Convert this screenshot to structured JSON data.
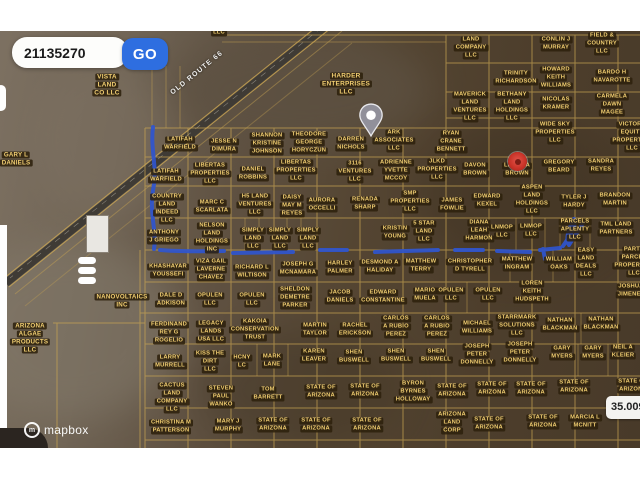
{
  "search": {
    "value": "21135270",
    "go_label": "GO"
  },
  "colors": {
    "goBlue": "#2e6ee0",
    "route": "#2f55cf",
    "markerRed": "#c93328",
    "labelText": "#f2cf72",
    "labelBg": "rgba(46,33,12,0.88)",
    "gridLine": "#c9a552"
  },
  "map": {
    "road_label": "OLD ROUTE 66",
    "coordinate_badge": "35.0096",
    "attribution": "mapbox",
    "parcel_format": [
      "text",
      "x",
      "y",
      "font_size_optional"
    ],
    "parcels": [
      [
        "VISTA\nLAND\nCO LLC",
        107,
        85,
        6.5
      ],
      [
        "LLC",
        219,
        33
      ],
      [
        "HARDER\nENTERPRISES\nLLC",
        346,
        84,
        6.5
      ],
      [
        "GARY L\nDANIELS",
        16,
        159,
        6.2
      ],
      [
        "NANOVOLTAICS\nINC",
        122,
        301,
        6.2
      ],
      [
        "ARIZONA\nALGAE\nPRODUCTS\nLLC",
        30,
        338,
        6.2
      ],
      [
        "LAND\nCOMPANY\nLLC",
        471,
        48
      ],
      [
        "CONLIN J\nMURRAY",
        556,
        44
      ],
      [
        "FIELD &\nCOUNTRY\nLLC",
        602,
        44
      ],
      [
        "TRINITY\nRICHARDSON",
        516,
        78
      ],
      [
        "HOWARD\nKEITH\nWILLIAMS",
        556,
        78
      ],
      [
        "BARDO H\nNAVAROTTE",
        612,
        77
      ],
      [
        "MAVERICK\nLAND\nVENTURES\nLLC",
        470,
        107
      ],
      [
        "BETHANY\nLAND\nHOLDINGS\nLLC",
        512,
        107
      ],
      [
        "NICOLAS\nKRAMER",
        556,
        104
      ],
      [
        "CARMELA\nDAWN\nMAGEE",
        612,
        105
      ],
      [
        "WIDE SKY\nPROPERTIES\nLLC",
        555,
        133
      ],
      [
        "VICTORY\nEQUITY\nPROPERTIES\nLLC",
        632,
        137
      ],
      [
        "RYAN\nCRANE\nBENNETT",
        451,
        142
      ],
      [
        "JLKD\nPROPERTIES\nLLC",
        437,
        170
      ],
      [
        "DAVON\nBROWN",
        475,
        170
      ],
      [
        "LATISHA\nBROWN",
        517,
        170
      ],
      [
        "GREGORY\nBEARD",
        559,
        167
      ],
      [
        "SANDRA\nREYES",
        601,
        166
      ],
      [
        "LATIFAH\nWARFIELD",
        180,
        144
      ],
      [
        "JESSE N\nDIMURA",
        224,
        146
      ],
      [
        "SHANNON\nKRISTINE\nJOHNSON",
        267,
        144
      ],
      [
        "THEODORE\nGEORGE\nHORYCZUN",
        309,
        143
      ],
      [
        "DARREN\nNICHOLS",
        351,
        144
      ],
      [
        "ARK\nASSOCIATES\nLLC",
        394,
        141
      ],
      [
        "LATIFAH\nWARFIELD",
        166,
        176
      ],
      [
        "LIBERTAS\nPROPERTIES\nLLC",
        210,
        174
      ],
      [
        "DANIEL\nROBBINS",
        253,
        174
      ],
      [
        "LIBERTAS\nPROPERTIES\nLLC",
        296,
        171
      ],
      [
        "3116\nVENTURES\nLLC",
        355,
        172
      ],
      [
        "ADRIENNE\nYVETTE\nMCCOY",
        396,
        171
      ],
      [
        "COUNTRY\nLAND\nINDEED\nLLC",
        167,
        209
      ],
      [
        "MARC C\nSCARLATA",
        212,
        207
      ],
      [
        "H5 LAND\nVENTURES\nLLC",
        255,
        205
      ],
      [
        "DAISY\nMAY M\nREYES",
        292,
        206
      ],
      [
        "AURORA\nOCCELLI",
        322,
        205
      ],
      [
        "RENADA\nSHARP",
        365,
        204
      ],
      [
        "SMP\nPROPERTIES\nLLC",
        410,
        202
      ],
      [
        "JAMES\nFOWLIE",
        452,
        205
      ],
      [
        "EDWARD\nKEXEL",
        487,
        201
      ],
      [
        "ASPEN\nLAND\nHOLDINGS\nLLC",
        532,
        200
      ],
      [
        "TYLER J\nHARDY",
        574,
        202
      ],
      [
        "BRANDON\nMARTIN",
        615,
        200
      ],
      [
        "ANTHONY\nJ GRIEGO",
        164,
        237
      ],
      [
        "NELSON\nLAND\nHOLDINGS\nINC",
        212,
        238
      ],
      [
        "SIMPLY\nLAND\nLLC",
        253,
        239
      ],
      [
        "SIMPLY\nLAND\nLLC",
        280,
        239
      ],
      [
        "SIMPLY\nLAND\nLLC",
        308,
        239
      ],
      [
        "KRISTIN\nYOUNG",
        395,
        233
      ],
      [
        "5 STAR\nLAND\nLLC",
        424,
        232
      ],
      [
        "DIANA\nLEAH\nHARMON",
        479,
        231
      ],
      [
        "LNMOP\nLLC",
        502,
        232
      ],
      [
        "LNMOP\nLLC",
        531,
        231
      ],
      [
        "PARCELS\nAPLENTY\nLLC",
        575,
        230
      ],
      [
        "TML LAND\nPARTNERS",
        616,
        229
      ],
      [
        "KHASHAYAR\nYOUSSEFI",
        168,
        271
      ],
      [
        "VIZA GAIL\nLAVERNE\nCHAVEZ",
        211,
        270
      ],
      [
        "RICHARD L\nWILTISON",
        252,
        272
      ],
      [
        "JOSEPH G\nMCNAMARA",
        298,
        269
      ],
      [
        "HARLEY\nPALMER",
        340,
        268
      ],
      [
        "DESMOND A\nHALIDAY",
        380,
        267
      ],
      [
        "MATTHEW\nTERRY",
        421,
        266
      ],
      [
        "CHRISTOPHER\nD TYRELL",
        470,
        266
      ],
      [
        "MATTHEW\nINGRAM",
        517,
        264
      ],
      [
        "WILLIAM\nOAKS",
        559,
        264
      ],
      [
        "EASY\nLAND\nDEALS\nLLC",
        586,
        263
      ],
      [
        "PARTY\nPARCEL\nPROPERTIES\nLLC",
        634,
        262
      ],
      [
        "DALE D\nADKISON",
        171,
        300
      ],
      [
        "OPULEN\nLLC",
        210,
        300
      ],
      [
        "OPULEN\nLLC",
        252,
        300
      ],
      [
        "SHELDON\nDEMETRE\nPARKER",
        295,
        298
      ],
      [
        "JACOB\nDANIELS",
        340,
        297
      ],
      [
        "EDWARD\nCONSTANTINE",
        383,
        297
      ],
      [
        "MARIO\nMUELA",
        425,
        295
      ],
      [
        "OPULEN\nLLC",
        451,
        295
      ],
      [
        "OPULEN\nLLC",
        488,
        295
      ],
      [
        "LOREN\nKEITH\nHUDSPETH",
        532,
        292
      ],
      [
        "JOSHUA\nJIMENEZ",
        631,
        291
      ],
      [
        "FERDINAND\nREY G\nROGELIO",
        169,
        333
      ],
      [
        "LEGACY\nLANDS\nUSA LLC",
        211,
        332
      ],
      [
        "KAKOIA\nCONSERVATION\nTRUST",
        255,
        330
      ],
      [
        "MARTIN\nTAYLOR",
        315,
        330
      ],
      [
        "RACHEL\nERICKSON",
        355,
        330
      ],
      [
        "CARLOS\nA RUBIO\nPEREZ",
        396,
        327
      ],
      [
        "CARLOS\nA RUBIO\nPEREZ",
        437,
        327
      ],
      [
        "MICHAEL\nWILLIAMS",
        477,
        328
      ],
      [
        "STARRMARK\nSOLUTIONS\nLLC",
        517,
        326
      ],
      [
        "NATHAN\nBLACKMAN",
        560,
        325
      ],
      [
        "NATHAN\nBLACKMAN",
        601,
        324
      ],
      [
        "LARRY\nMURRELL",
        170,
        362
      ],
      [
        "KISS THE\nDIRT\nLLC",
        210,
        362
      ],
      [
        "HCNY\nLC",
        242,
        362
      ],
      [
        "MARK\nLANE",
        272,
        361
      ],
      [
        "KAREN\nLEAVER",
        314,
        356
      ],
      [
        "SHEN\nBUSWELL",
        354,
        357
      ],
      [
        "SHEN\nBUSWELL",
        396,
        356
      ],
      [
        "SHEN\nBUSWELL",
        436,
        356
      ],
      [
        "JOSEPH\nPETER\nDONNELLY",
        477,
        355
      ],
      [
        "JOSEPH\nPETER\nDONNELLY",
        520,
        353
      ],
      [
        "GARY\nMYERS",
        562,
        353
      ],
      [
        "GARY\nMYERS",
        593,
        353
      ],
      [
        "NEIL A\nKLEIER",
        623,
        352
      ],
      [
        "CACTUS\nLAND\nCOMPANY\nLLC",
        172,
        398
      ],
      [
        "STEVEN\nPAUL\nWANKO",
        221,
        397
      ],
      [
        "TOM\nBARRETT",
        268,
        394
      ],
      [
        "STATE OF\nARIZONA",
        321,
        392
      ],
      [
        "STATE OF\nARIZONA",
        365,
        391
      ],
      [
        "BYRON\nBYRNES\nHOLLOWAY",
        413,
        392
      ],
      [
        "STATE OF\nARIZONA",
        452,
        391
      ],
      [
        "STATE OF\nARIZONA",
        492,
        389
      ],
      [
        "STATE OF\nARIZONA",
        531,
        389
      ],
      [
        "STATE OF\nARIZONA",
        574,
        387
      ],
      [
        "STATE OF\nARIZONA",
        633,
        386
      ],
      [
        "CHRISTINA M\nPATTERSON",
        171,
        427
      ],
      [
        "MARY J\nMURPHY",
        228,
        426
      ],
      [
        "STATE OF\nARIZONA",
        273,
        425
      ],
      [
        "STATE OF\nARIZONA",
        316,
        425
      ],
      [
        "STATE OF\nARIZONA",
        367,
        425
      ],
      [
        "ARIZONA\nLAND\nCORP",
        452,
        423
      ],
      [
        "STATE OF\nARIZONA",
        489,
        424
      ],
      [
        "STATE OF\nARIZONA",
        543,
        422
      ],
      [
        "MARCIA L\nMCNITT",
        585,
        422
      ]
    ]
  }
}
